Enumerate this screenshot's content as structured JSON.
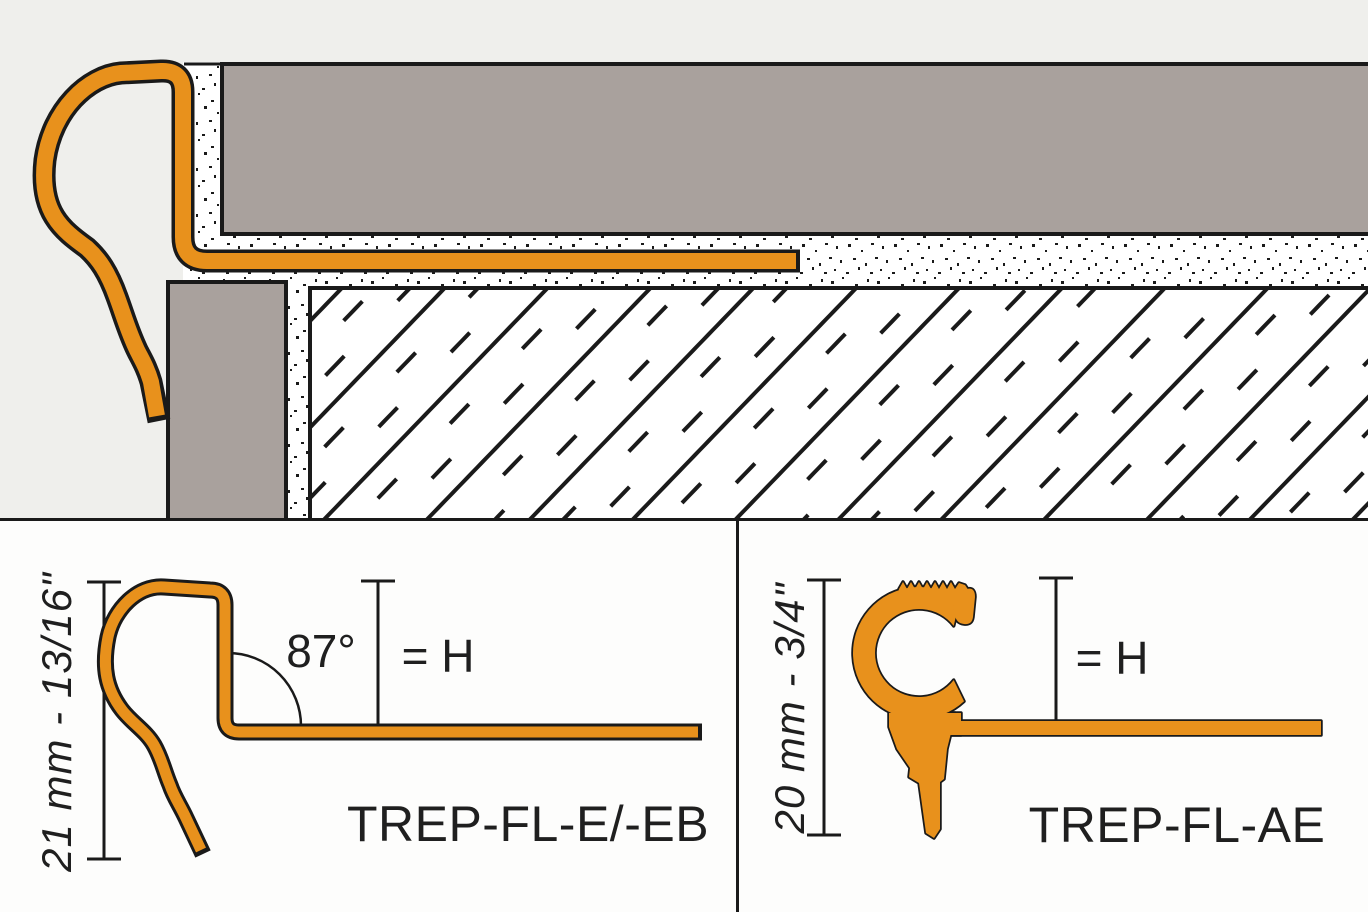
{
  "colors": {
    "profile_orange": "#E8911C",
    "outline_black": "#1A1A1A",
    "tile_gray": "#A9A19D",
    "backdrop_gray": "#EFEFEC",
    "panel_white": "#FDFDFC"
  },
  "panels": {
    "left": {
      "dimension_label": "21 mm - 13/16\"",
      "angle_label": "87°",
      "height_label": "= H",
      "product_label": "TREP-FL-E/-EB"
    },
    "right": {
      "dimension_label": "20 mm - 3/4\"",
      "height_label": "= H",
      "product_label": "TREP-FL-AE"
    }
  }
}
